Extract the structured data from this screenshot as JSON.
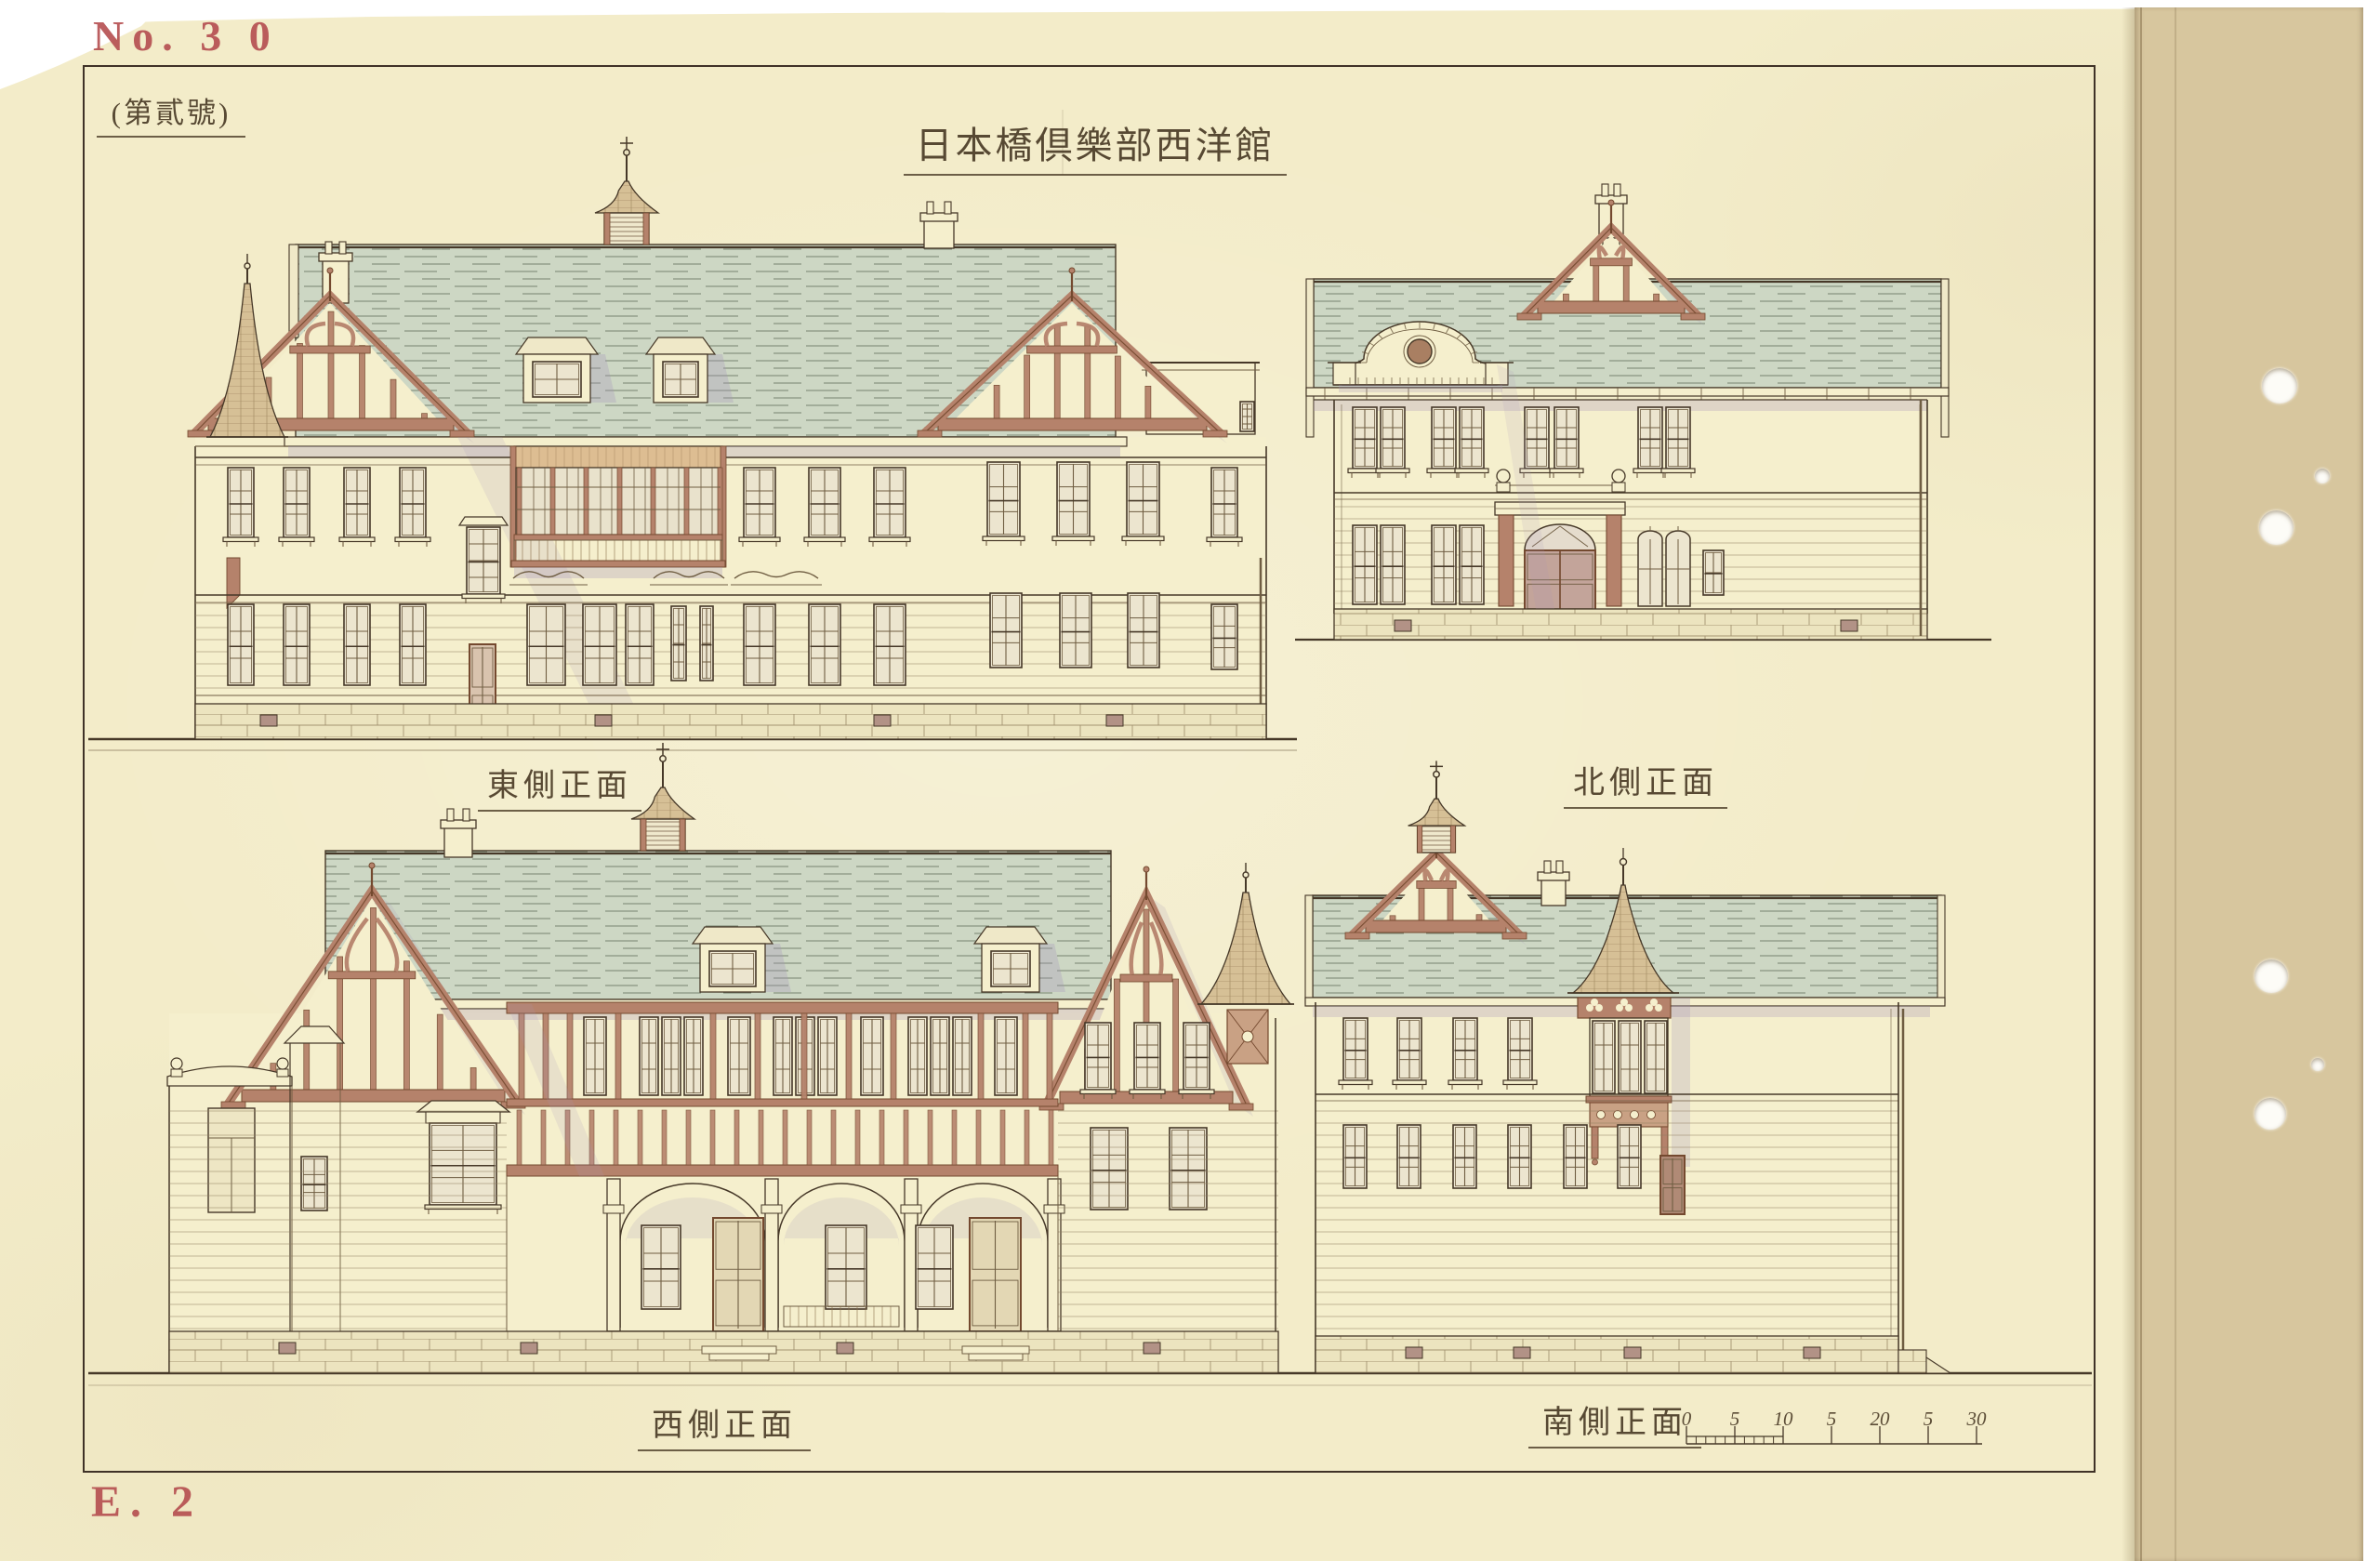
{
  "sheet": {
    "stamp_no": "No. 3 0",
    "stamp_code": "E. 2",
    "plate_label": "(第貳號)",
    "title": "日本橋倶樂部西洋館",
    "elevations": [
      {
        "id": "east",
        "label": "東側正面"
      },
      {
        "id": "north",
        "label": "北側正面"
      },
      {
        "id": "west",
        "label": "西側正面"
      },
      {
        "id": "south",
        "label": "南側正面"
      }
    ],
    "scale_bar": {
      "ticks": [
        "0",
        "5",
        "10",
        "5",
        "20",
        "5",
        "30"
      ]
    },
    "colors": {
      "paper": "#f3ecc9",
      "ink": "#463828",
      "stamp_red": "#b3494c",
      "roof_green": "#cdd7c4",
      "timber_brown": "#b5826b",
      "shadow_mauve": "#a795b8",
      "binding_tan": "#d7c69e"
    }
  }
}
